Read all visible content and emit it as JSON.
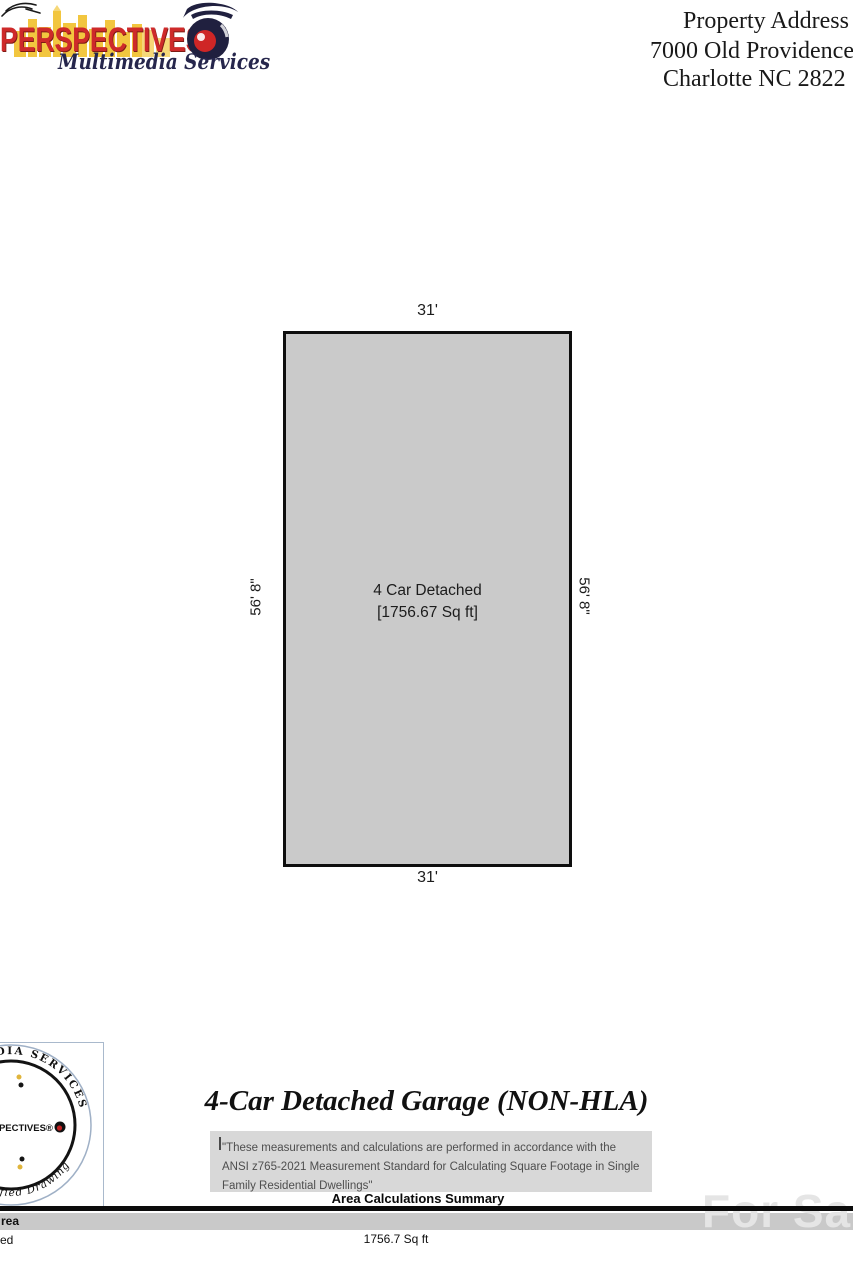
{
  "header": {
    "logo": {
      "brand": "PERSPECTIVES",
      "tagline": "Multimedia Services",
      "icons": {
        "bird": "bird-sketch-icon",
        "camera": "camera-icon",
        "skyline": "city-skyline-graphic"
      }
    },
    "property_address": {
      "label": "Property Address",
      "street": "7000 Old Providence",
      "city": "Charlotte NC 2822"
    }
  },
  "floor_plan": {
    "width_top": "31'",
    "width_bottom": "31'",
    "height_left": "56' 8\"",
    "height_right": "56' 8\"",
    "room_name": "4 Car Detached",
    "room_area": "[1756.67 Sq ft]",
    "fill_color": "#cacaca"
  },
  "certification_stamp": {
    "arc_top": "MULTIMEDIA SERVICES",
    "center_brand": "PERSPECTIVES®",
    "arc_bottom": "2021 Certified Drawing"
  },
  "summary": {
    "title": "4-Car Detached Garage (NON-HLA)",
    "disclaimer": "\"These measurements and calculations are performed in accordance with the ANSI z765-2021 Measurement Standard for Calculating Square Footage in Single Family Residential Dwellings\"",
    "table_title": "Area Calculations Summary",
    "table": {
      "header_cell": "rea",
      "row_label": "ed",
      "row_value": "1756.7 Sq ft"
    }
  },
  "watermark": "For Sale",
  "colors": {
    "brand_red": "#ce2a2a",
    "brand_navy": "#20203f",
    "skyline_yellow": "#f2c63f",
    "plan_fill": "#cacaca",
    "note_bg": "#d8d8d8",
    "band_gray": "#c9c9c9",
    "watermark_gray": "#e5e5e5"
  }
}
